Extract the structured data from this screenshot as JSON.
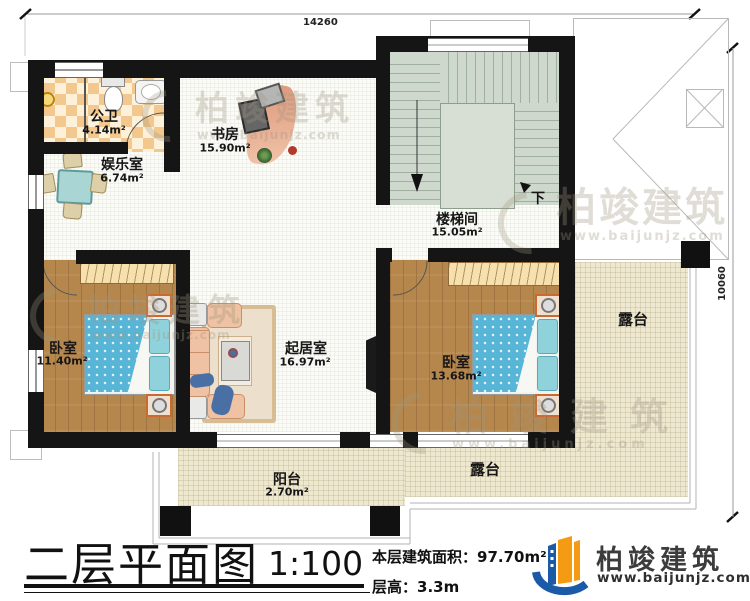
{
  "dimensions": {
    "top": "14260",
    "right": "10060"
  },
  "rooms": {
    "bathroom": {
      "name": "公卫",
      "area": "4.14m²"
    },
    "entertainment": {
      "name": "娱乐室",
      "area": "6.74m²"
    },
    "study": {
      "name": "书房",
      "area": "15.90m²"
    },
    "stairwell": {
      "name": "楼梯间",
      "area": "15.05m²"
    },
    "bedroom1": {
      "name": "卧室",
      "area": "11.40m²"
    },
    "living": {
      "name": "起居室",
      "area": "16.97m²"
    },
    "bedroom2": {
      "name": "卧室",
      "area": "13.68m²"
    },
    "balcony": {
      "name": "阳台",
      "area": "2.70m²"
    },
    "terrace_right": {
      "name": "露台"
    },
    "terrace_bottom": {
      "name": "露台"
    }
  },
  "stairs": {
    "down_label": "下"
  },
  "footer": {
    "title": "二层平面图",
    "scale": "1:100",
    "area_label": "本层建筑面积：",
    "area_value": "97.70m²",
    "height_label": "层高：",
    "height_value": "3.3m"
  },
  "brand": {
    "name": "柏竣建筑",
    "site": "www.baijunjz.com"
  },
  "colors": {
    "brand_blue": "#1a5aa6",
    "brand_orange": "#f49a13",
    "wall": "#151515",
    "stair_floor": "#ced8cd",
    "wood_floor": "#b5874d",
    "terrace_floor": "#efe8d1",
    "bed_blue": "#57b6d8"
  }
}
